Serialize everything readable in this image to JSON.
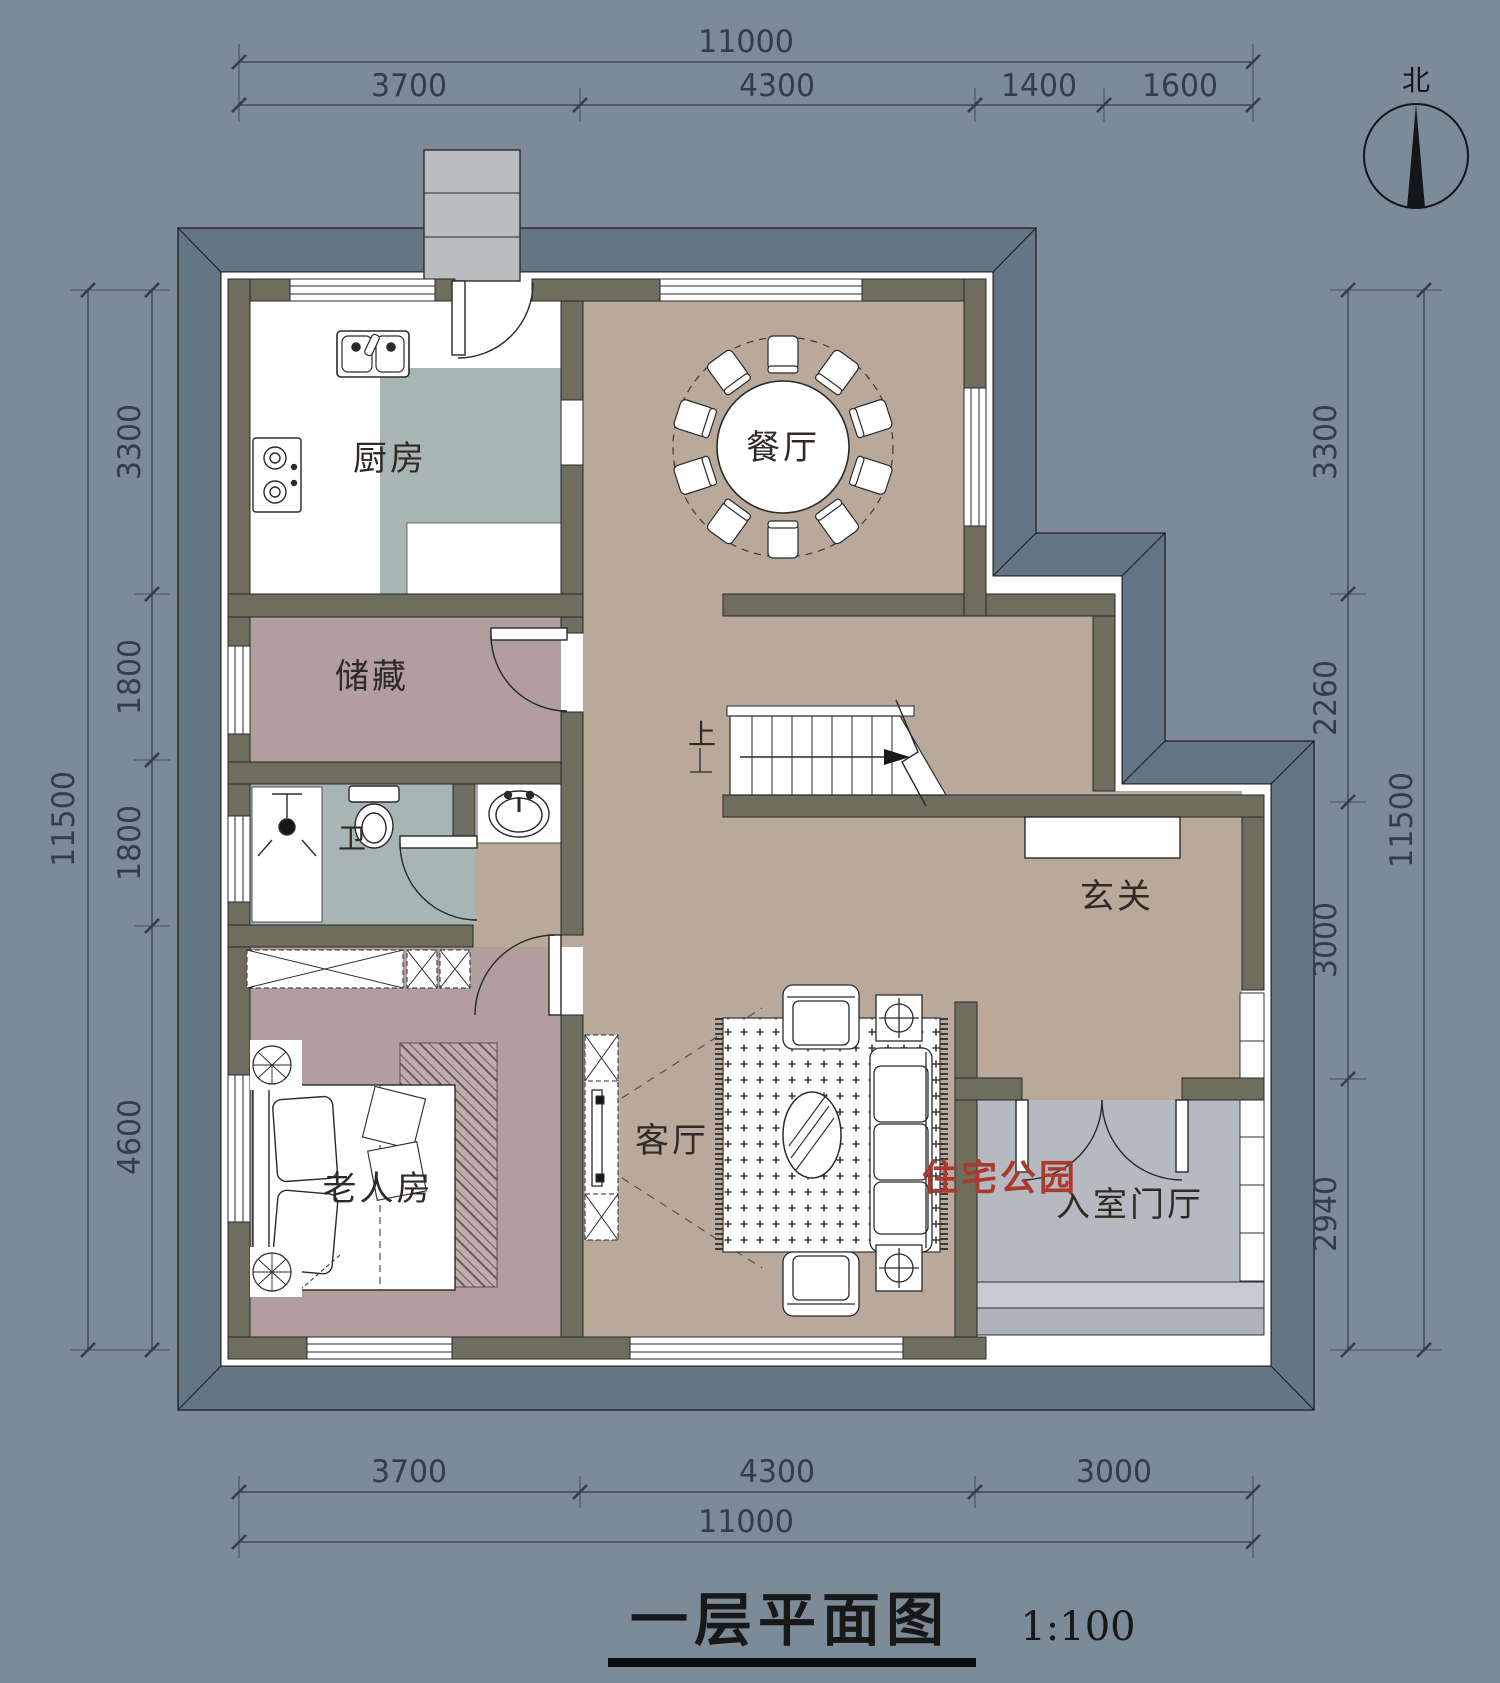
{
  "title": {
    "text": "一层平面图",
    "scale": "1:100"
  },
  "compass": {
    "label": "北"
  },
  "watermark": {
    "text": "住宅公园"
  },
  "rooms": {
    "kitchen": "厨房",
    "dining": "餐厅",
    "storage": "储藏",
    "bathroom": "卫",
    "hallway": "玄关",
    "elderly_bedroom": "老人房",
    "living": "客厅",
    "entry_foyer": "入室门厅"
  },
  "stairs": {
    "up_label": "上",
    "treads": 8
  },
  "dining_set": {
    "chairs": 10
  },
  "dimensions": {
    "top": {
      "total": "11000",
      "segments": [
        "3700",
        "4300",
        "1400",
        "1600"
      ]
    },
    "bottom": {
      "total": "11000",
      "segments": [
        "3700",
        "4300",
        "3000"
      ]
    },
    "left": {
      "total": "11500",
      "segments": [
        "3300",
        "1800",
        "1800",
        "4600"
      ]
    },
    "right": {
      "total": "11500",
      "segments": [
        "3300",
        "2260",
        "3000",
        "2940"
      ]
    }
  },
  "colors": {
    "background": "#7c8b97",
    "eave": "#647583",
    "wall": "#6f6d5d",
    "floor_main": "#b8a99a",
    "floor_cool": "#a7b6b4",
    "floor_mauve": "#b29e9c",
    "floor_porch": "#b6bac0",
    "step_light": "#c6cbd0",
    "chimney": "#b9bdc0",
    "line": "#24272b",
    "dim_text": "#343d49",
    "label_text": "#2f2a26",
    "accent_red": "#a93a31"
  }
}
